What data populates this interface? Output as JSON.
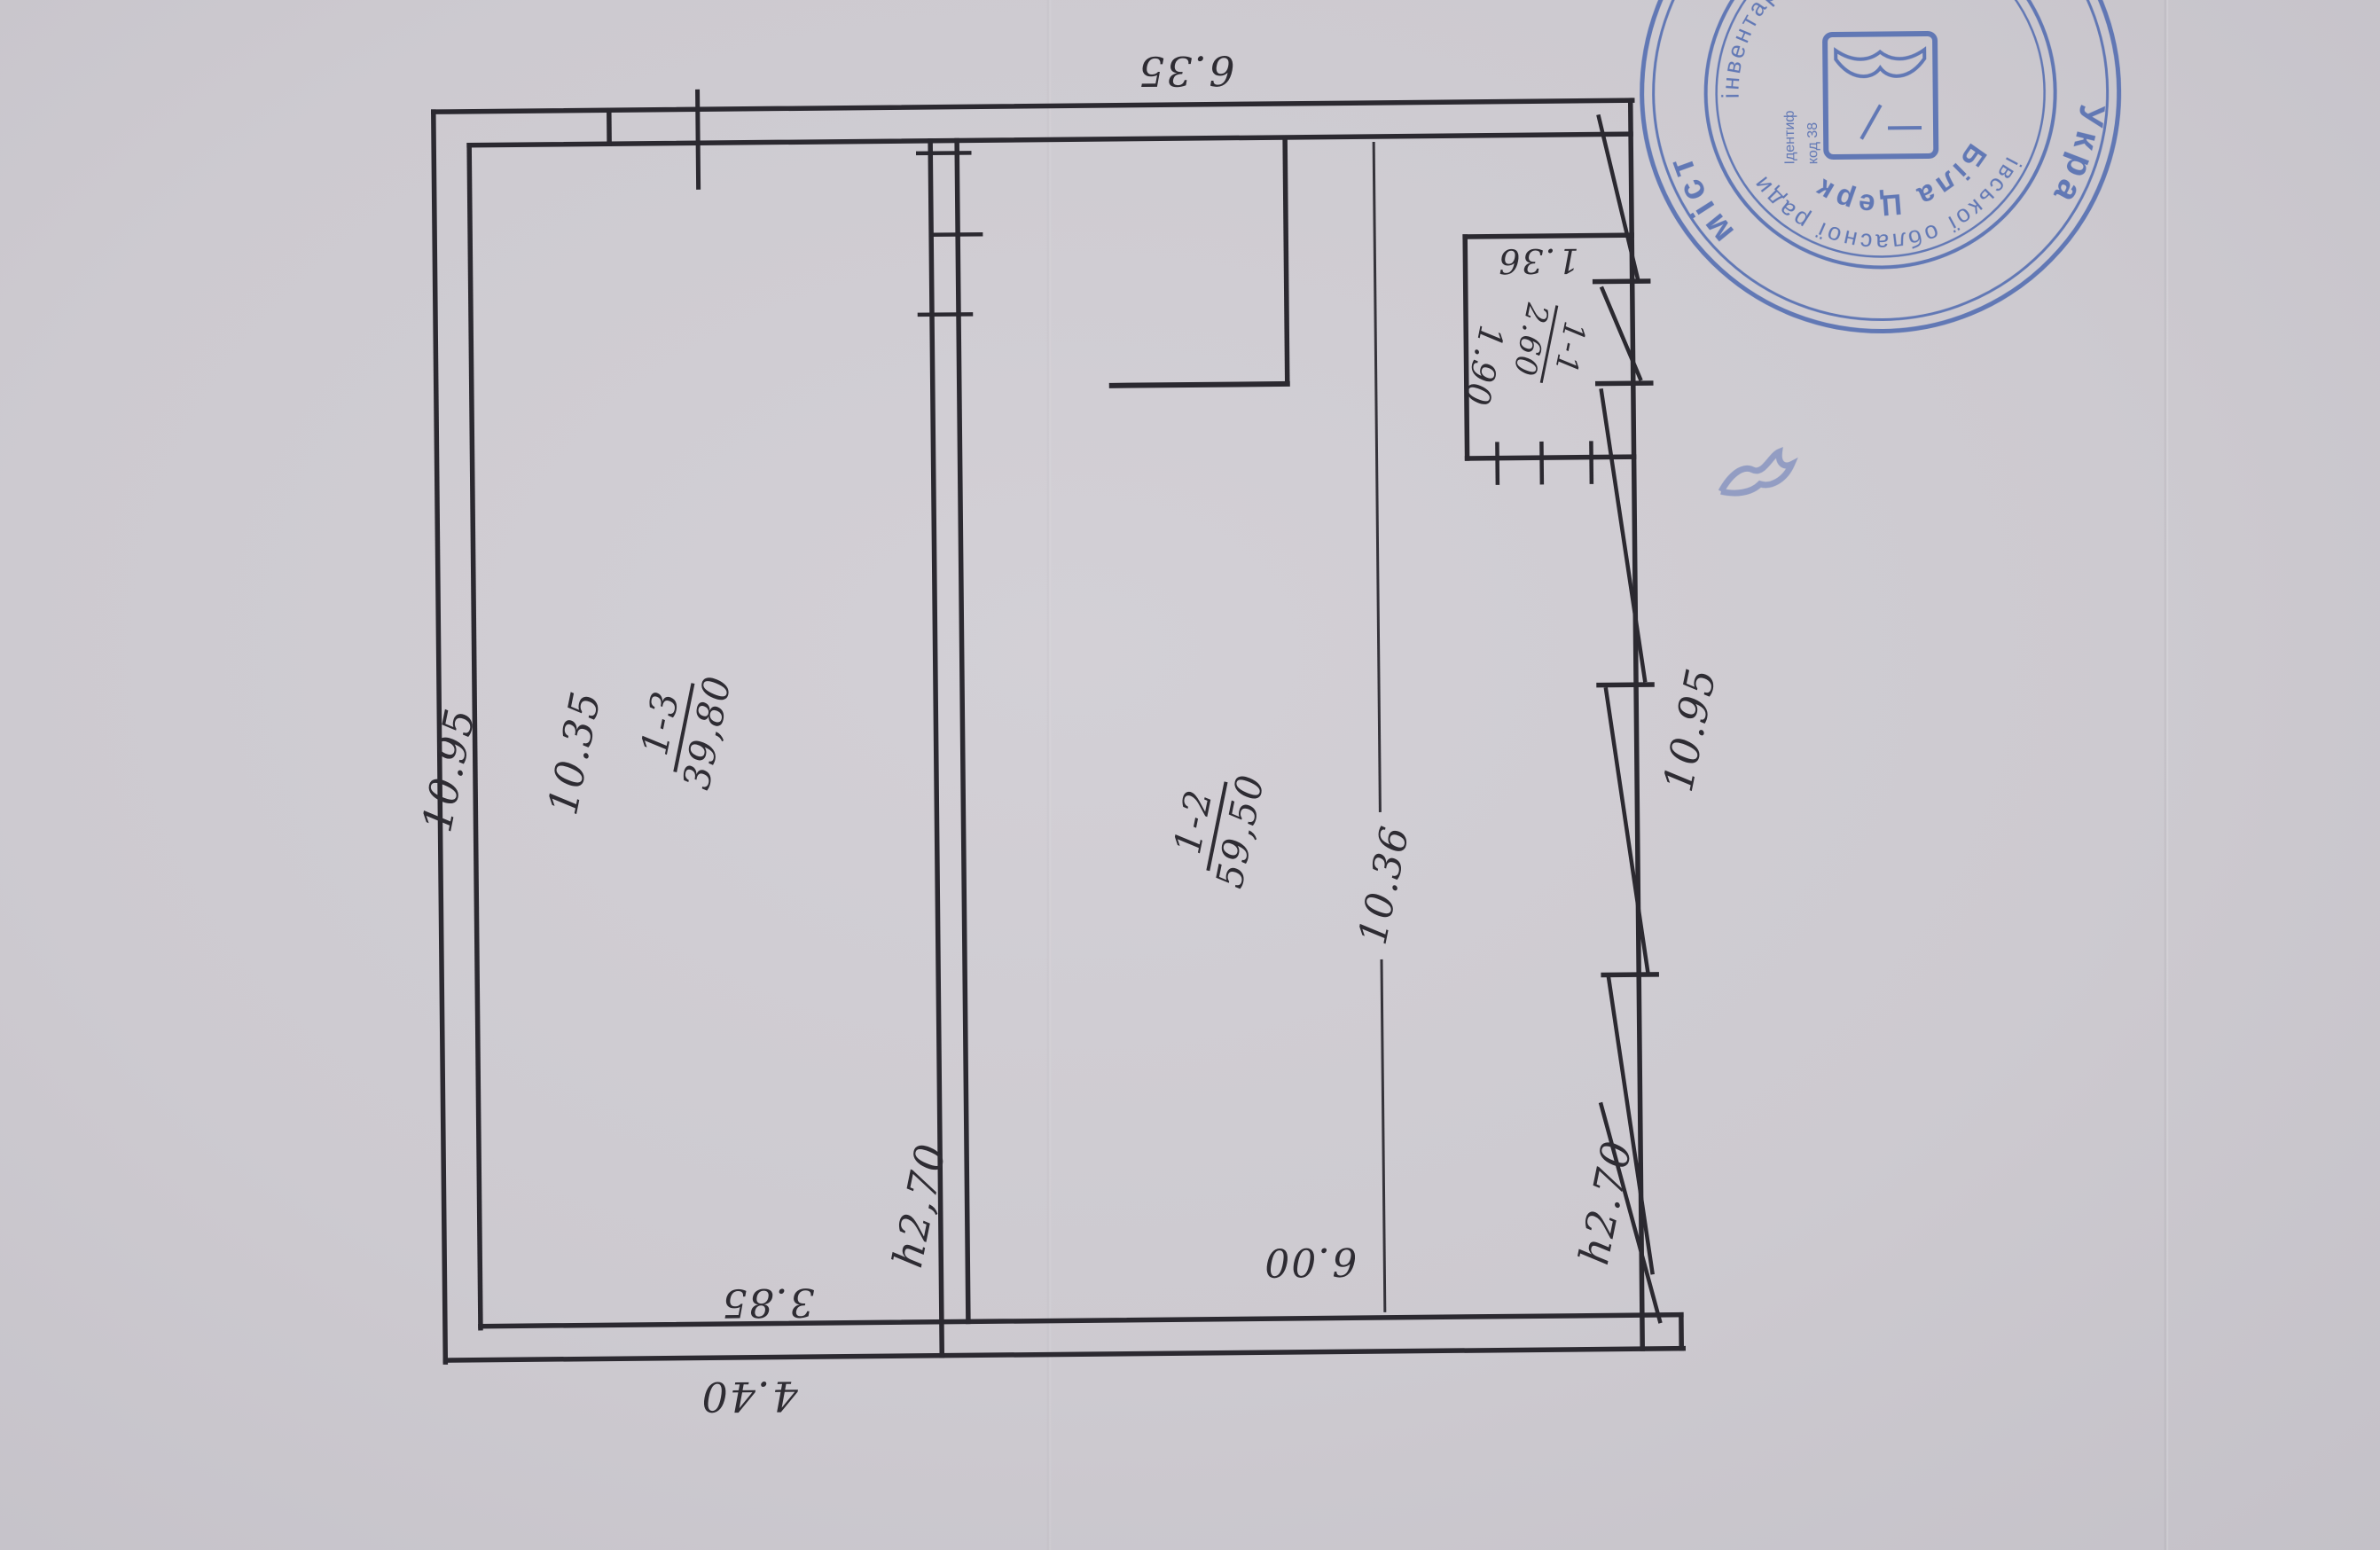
{
  "document_type": "scanned floor plan sheet",
  "colors": {
    "paper": "#cfccd3",
    "ink": "#2b2930",
    "stamp_blue": "#4d68b0"
  },
  "plan": {
    "rooms": [
      {
        "number": "1-3",
        "area": "39,80"
      },
      {
        "number": "1-2",
        "area": "59,50"
      },
      {
        "number": "1-1",
        "area": "2.60"
      }
    ],
    "dimensions": {
      "top_width": "6.35",
      "left_outer": "10.95",
      "left_inner": "10.35",
      "right_outer": "10.95",
      "interior_height": "10.36",
      "bottom_room2": "6.00",
      "bottom_inner": "3.85",
      "bottom_outer": "4.40",
      "closet_width": "1.36",
      "closet_depth": "1.90",
      "height_left": "h2,70",
      "height_right": "h2.70"
    }
  },
  "stamp": {
    "outer_left": "Укра",
    "outer_right": "міст",
    "ring_text": "івської обласної ради",
    "ring_text2": "інвентаризаці",
    "inner_text": "Біла Церк",
    "center_line1": "Ідентиф",
    "center_line2": "код 38"
  }
}
